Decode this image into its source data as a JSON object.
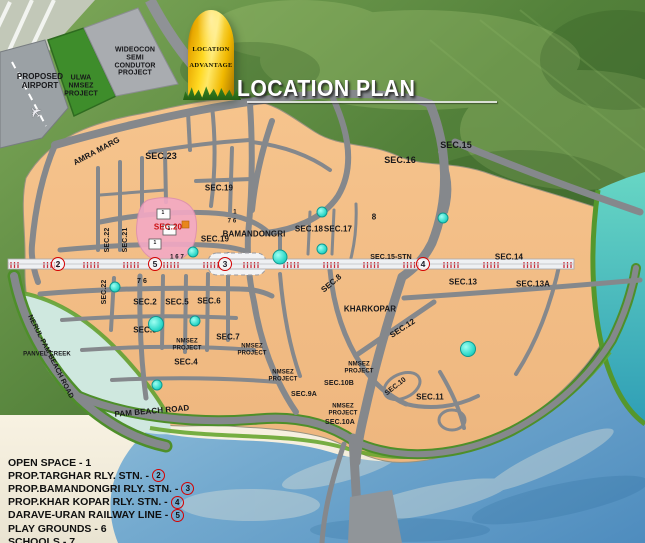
{
  "plan": {
    "title": "LOCATION PLAN"
  },
  "milestone": {
    "line1": "LOCATION",
    "line2": "ADVANTAGE"
  },
  "icons": {
    "airplane": "✈"
  },
  "palette": {
    "land": "#f3bf89",
    "hills": "#53813a",
    "water_teal": "#3db8b0",
    "water_blue": "#6aa8cc",
    "road": "#85888c",
    "railway_tick": "#c8303c",
    "sector_highlight": "#f3a9c4",
    "playground": "#2cd8c8",
    "marker_red": "#d40000"
  },
  "legend": {
    "items": [
      {
        "text": "OPEN SPACE - 1"
      },
      {
        "text": "PROP.TARGHAR RLY. STN. -",
        "marker": "2"
      },
      {
        "text": "PROP.BAMANDONGRI RLY. STN. -",
        "marker": "3"
      },
      {
        "text": "PROP.KHAR KOPAR RLY. STN. -",
        "marker": "4"
      },
      {
        "text": "DARAVE-URAN RAILWAY LINE -",
        "marker": "5"
      },
      {
        "text": "PLAY GROUNDS - 6"
      },
      {
        "text": "SCHOOLS - 7"
      }
    ]
  },
  "railway_markers": [
    {
      "n": "2",
      "x": 58,
      "y": 264
    },
    {
      "n": "5",
      "x": 155,
      "y": 264
    },
    {
      "n": "3",
      "x": 225,
      "y": 264
    },
    {
      "n": "4",
      "x": 423,
      "y": 264
    }
  ],
  "playground_dots": [
    {
      "x": 193,
      "y": 252
    },
    {
      "x": 280,
      "y": 257,
      "d": 13
    },
    {
      "x": 322,
      "y": 212
    },
    {
      "x": 322,
      "y": 249
    },
    {
      "x": 443,
      "y": 218
    },
    {
      "x": 115,
      "y": 287
    },
    {
      "x": 156,
      "y": 324,
      "d": 14
    },
    {
      "x": 195,
      "y": 321
    },
    {
      "x": 157,
      "y": 385
    },
    {
      "x": 468,
      "y": 349,
      "d": 14
    }
  ],
  "map_labels": [
    {
      "t": "PROPOSED\nAIRPORT",
      "x": 40,
      "y": 82,
      "s": 8
    },
    {
      "t": "ULWA\nNMSEZ\nPROJECT",
      "x": 81,
      "y": 86,
      "s": 7
    },
    {
      "t": "WIDEOCON\nSEMI\nCONDUTOR\nPROJECT",
      "x": 135,
      "y": 62,
      "s": 7
    },
    {
      "t": "AMRA MARG",
      "x": 97,
      "y": 152,
      "r": -28,
      "s": 8
    },
    {
      "t": "SEC.23",
      "x": 161,
      "y": 156,
      "s": 9
    },
    {
      "t": "SEC.19",
      "x": 219,
      "y": 189,
      "s": 8
    },
    {
      "t": "SEC.16",
      "x": 400,
      "y": 160,
      "s": 9
    },
    {
      "t": "SEC.15",
      "x": 456,
      "y": 145,
      "s": 9
    },
    {
      "t": "8",
      "x": 374,
      "y": 218,
      "s": 8
    },
    {
      "t": "SEC.18",
      "x": 309,
      "y": 230,
      "s": 8
    },
    {
      "t": "SEC.17",
      "x": 338,
      "y": 230,
      "s": 8
    },
    {
      "t": "SEC.19",
      "x": 215,
      "y": 240,
      "s": 8
    },
    {
      "t": "BAMANDONGRI",
      "x": 254,
      "y": 235,
      "s": 8
    },
    {
      "t": "SEC.20",
      "x": 168,
      "y": 228,
      "s": 8,
      "c": "#cc1111"
    },
    {
      "t": "SEC.22",
      "x": 108,
      "y": 240,
      "r": -90,
      "s": 7
    },
    {
      "t": "SEC.21",
      "x": 126,
      "y": 240,
      "r": -90,
      "s": 7
    },
    {
      "t": "1",
      "x": 235,
      "y": 213,
      "s": 6
    },
    {
      "t": "7 6",
      "x": 232,
      "y": 222,
      "s": 6
    },
    {
      "t": "1",
      "x": 163,
      "y": 214,
      "s": 5
    },
    {
      "t": "1",
      "x": 169,
      "y": 230,
      "s": 5
    },
    {
      "t": "1",
      "x": 155,
      "y": 244,
      "s": 5
    },
    {
      "t": "1 6 7",
      "x": 177,
      "y": 258,
      "s": 6
    },
    {
      "t": "SEC.15-STN",
      "x": 391,
      "y": 258,
      "s": 7
    },
    {
      "t": "SEC.14",
      "x": 509,
      "y": 258,
      "s": 8
    },
    {
      "t": "SEC.13",
      "x": 463,
      "y": 283,
      "s": 8
    },
    {
      "t": "SEC.13A",
      "x": 533,
      "y": 285,
      "s": 8
    },
    {
      "t": "SEC.8",
      "x": 332,
      "y": 284,
      "r": -40,
      "s": 8
    },
    {
      "t": "KHARKOPAR",
      "x": 370,
      "y": 310,
      "s": 8
    },
    {
      "t": "SEC.12",
      "x": 403,
      "y": 329,
      "r": -33,
      "s": 8
    },
    {
      "t": "SEC.22",
      "x": 105,
      "y": 292,
      "r": -90,
      "s": 7
    },
    {
      "t": "7 6",
      "x": 142,
      "y": 282,
      "s": 7
    },
    {
      "t": "SEC.2",
      "x": 145,
      "y": 303,
      "s": 8
    },
    {
      "t": "SEC.5",
      "x": 177,
      "y": 303,
      "s": 8
    },
    {
      "t": "SEC.6",
      "x": 209,
      "y": 302,
      "s": 8
    },
    {
      "t": "SEC.3",
      "x": 145,
      "y": 331,
      "s": 8
    },
    {
      "t": "NMSEZ\nPROJECT",
      "x": 187,
      "y": 345,
      "s": 6
    },
    {
      "t": "SEC.7",
      "x": 228,
      "y": 338,
      "s": 8
    },
    {
      "t": "NMSEZ\nPROJECT",
      "x": 252,
      "y": 350,
      "s": 6
    },
    {
      "t": "SEC.4",
      "x": 186,
      "y": 363,
      "s": 8
    },
    {
      "t": "NMSEZ\nPROJECT",
      "x": 283,
      "y": 376,
      "s": 6
    },
    {
      "t": "SEC.9A",
      "x": 304,
      "y": 395,
      "s": 7
    },
    {
      "t": "NMSEZ\nPROJECT",
      "x": 359,
      "y": 368,
      "s": 6
    },
    {
      "t": "SEC.10B",
      "x": 339,
      "y": 384,
      "s": 7
    },
    {
      "t": "NMSEZ\nPROJECT",
      "x": 343,
      "y": 410,
      "s": 6
    },
    {
      "t": "SEC.10A",
      "x": 340,
      "y": 423,
      "s": 7
    },
    {
      "t": "SEC.10",
      "x": 396,
      "y": 387,
      "r": -38,
      "s": 7
    },
    {
      "t": "SEC.11",
      "x": 430,
      "y": 398,
      "s": 8
    },
    {
      "t": "PANVEL CREEK",
      "x": 47,
      "y": 355,
      "s": 6
    },
    {
      "t": "NERUL-PAM BEACH ROAD",
      "x": 50,
      "y": 357,
      "r": 63,
      "s": 7
    },
    {
      "t": "PAM BEACH ROAD",
      "x": 152,
      "y": 412,
      "r": -5,
      "s": 8
    }
  ]
}
